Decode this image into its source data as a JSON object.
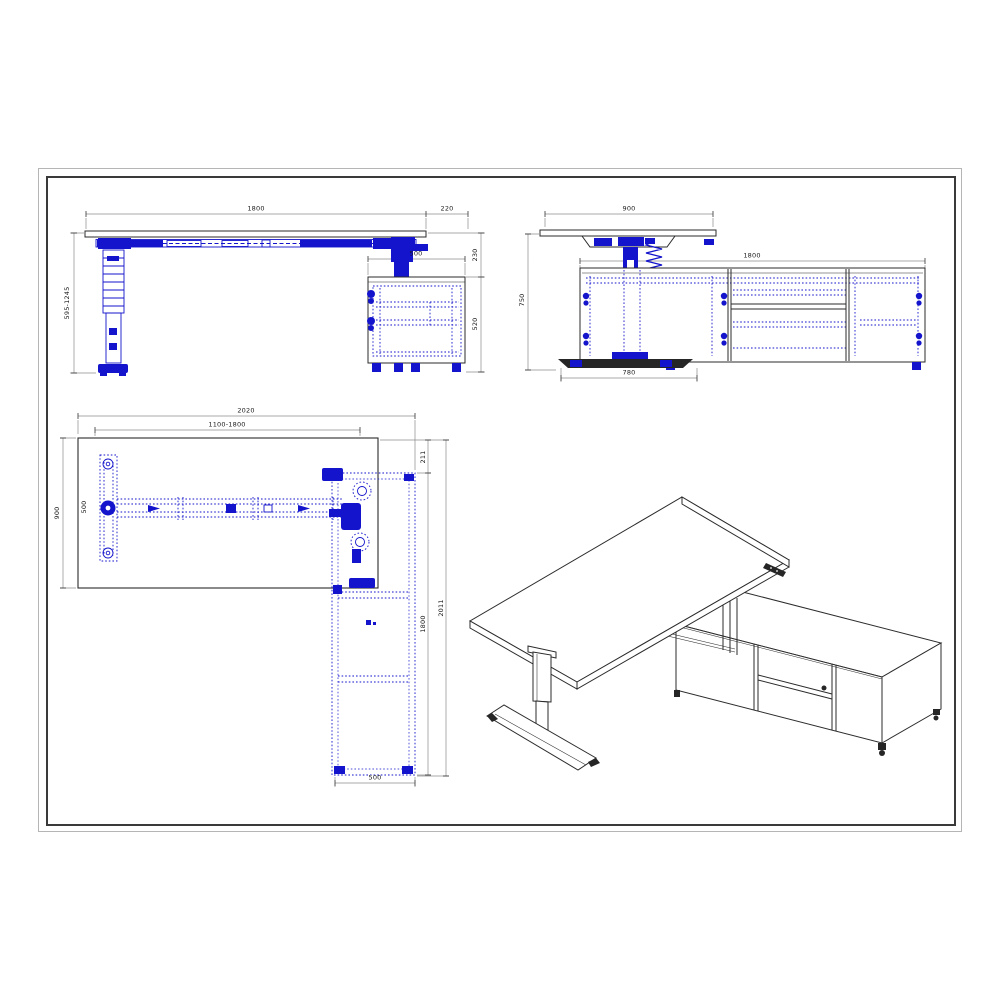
{
  "colors": {
    "hardware": "#1414cc",
    "outline": "#2b2b2b",
    "dimension": "#8c8c8c",
    "text": "#1a1a1a"
  },
  "views": {
    "front": {
      "dims": {
        "desk_width": "1800",
        "top_overhang": "220",
        "height_range": "595-1245",
        "cabinet_depth": "500",
        "clearance": "230",
        "cabinet_height": "520"
      }
    },
    "side": {
      "dims": {
        "desk_depth": "900",
        "credenza_length": "1800",
        "desk_height": "750",
        "foot_length": "780"
      }
    },
    "plan": {
      "dims": {
        "overall_width": "2020",
        "width_range": "1100-1800",
        "desk_depth": "900",
        "leg_span": "500",
        "return_offset": "211",
        "credenza_length": "1800",
        "overall_depth": "2011",
        "credenza_depth": "500"
      }
    }
  }
}
